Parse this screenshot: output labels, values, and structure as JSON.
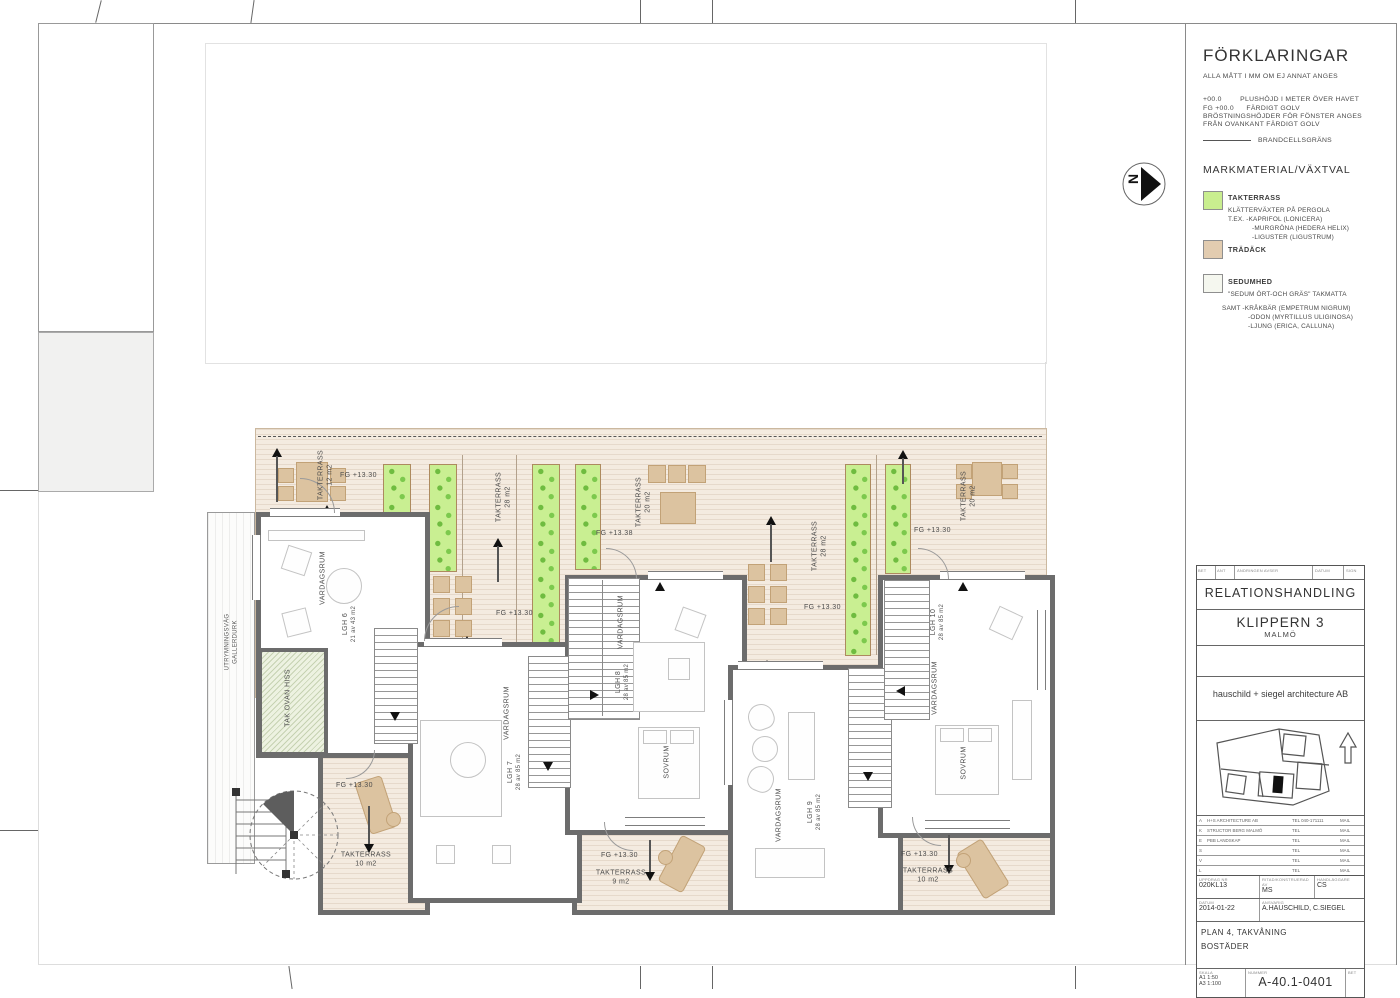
{
  "sheet": {
    "north_letter": "N",
    "legend": {
      "title": "FÖRKLARINGAR",
      "note1": "ALLA MÅTT I MM OM EJ ANNAT ANGES",
      "note2a": "+00.0",
      "note2b": "PLUSHÖJD I METER ÖVER HAVET",
      "note3a": "FG +00.0",
      "note3b": "FÄRDIGT GOLV",
      "note4a": "BRÖSTNINGSHÖJDER  FÖR FÖNSTER ANGES",
      "note4b": "FRÅN OVANKANT FÄRDIGT GOLV",
      "brandcell": "BRANDCELLSGRÄNS",
      "section_title": "MARKMATERIAL/VÄXTVAL",
      "items": [
        {
          "name": "TAKTERRASS",
          "desc1": "KLÄTTERVÄXTER PÅ PERGOLA",
          "desc2": "T.EX.   -KAPRIFOL   (LONICERA)",
          "desc3": "-MURGRÖNA   (HEDERA HELIX)",
          "desc4": "-LIGUSTER (LIGUSTRUM)",
          "color": "#c9ee8f"
        },
        {
          "name": "TRÄDÄCK",
          "color": "#e2ccb0"
        },
        {
          "name": "SEDUMHED",
          "desc1": "\"SEDUM ÖRT-OCH GRÄS\"  TAKMATTA",
          "desc2": "SAMT   -KRÅKBÄR   (EMPETRUM NIGRUM)",
          "desc3": "-ODON   (MYRTILLUS ULIGINOSA)",
          "desc4": "-LJUNG (ERICA, CALLUNA)",
          "color": "#f5f7ef"
        }
      ]
    },
    "titleblock": {
      "rev_cols": [
        "BET",
        "ANT",
        "ÄNDRINGEN AVSER",
        "DATUM",
        "SIGN"
      ],
      "status": "RELATIONSHANDLING",
      "project": "KLIPPERN 3",
      "city": "MALMÖ",
      "firm": "hauschild + siegel architecture AB",
      "consultants": [
        {
          "code": "A",
          "name": "H+S ARCHITECTURE AB",
          "tel": "TEL 040-171111",
          "mail": "MAIL"
        },
        {
          "code": "K",
          "name": "STRUCTOR BERG MALMÖ",
          "tel": "TEL",
          "mail": "MAIL"
        },
        {
          "code": "E",
          "name": "PBB LANDSKAP",
          "tel": "TEL",
          "mail": "MAIL"
        },
        {
          "code": "S",
          "name": "",
          "tel": "TEL",
          "mail": "MAIL"
        },
        {
          "code": "V",
          "name": "",
          "tel": "TEL",
          "mail": "MAIL"
        },
        {
          "code": "L",
          "name": "",
          "tel": "TEL",
          "mail": "MAIL"
        }
      ],
      "labels": {
        "uppdrag": "UPPDRAG NR",
        "ritad": "RITAD/KONSTRUERAD AV",
        "handl": "HANDLÄGGARE",
        "datum": "DATUM",
        "ansvarig": "ANSVARIG",
        "skala": "SKALA",
        "nummer": "NUMMER",
        "bet": "BET"
      },
      "uppdrag_nr": "020KL13",
      "ritad_av": "MS",
      "handlaggare": "CS",
      "datum": "2014-01-22",
      "ansvarig": "A.HAUSCHILD, C.SIEGEL",
      "content_line1": "PLAN 4, TAKVÅNING",
      "content_line2": "BOSTÄDER",
      "skala1": "A1   1:50",
      "skala2": "A3   1:100",
      "nummer": "A-40.1-0401"
    },
    "plan": {
      "apartments": [
        {
          "id": "LGH 6",
          "area": "21 av 43 m2",
          "room": "VARDAGSRUM"
        },
        {
          "id": "LGH 7",
          "area": "28 av 85 m2",
          "room": "VARDAGSRUM"
        },
        {
          "id": "LGH 8",
          "area": "28 av 85 m2",
          "room": "VARDAGSRUM",
          "room2": "SOVRUM"
        },
        {
          "id": "LGH 9",
          "area": "28 av 85 m2",
          "room": "VARDAGSRUM"
        },
        {
          "id": "LGH 10",
          "area": "28 av 85 m2",
          "room": "VARDAGSRUM",
          "room2": "SOVRUM"
        }
      ],
      "terraces": [
        {
          "name": "TAKTERRASS",
          "area": "12 m2"
        },
        {
          "name": "TAKTERRASS",
          "area": "28 m2"
        },
        {
          "name": "TAKTERRASS",
          "area": "20 m2"
        },
        {
          "name": "TAKTERRASS",
          "area": "28 m2"
        },
        {
          "name": "TAKTERRASS",
          "area": "20 m2"
        },
        {
          "name": "TAKTERRASS",
          "area": "10 m2"
        },
        {
          "name": "TAKTERRASS",
          "area": "9 m2"
        },
        {
          "name": "TAKTERRASS",
          "area": "10 m2"
        }
      ],
      "fg_main": "FG +13.30",
      "fg_alt": "FG +13.38",
      "tak_ovan_hiss": "TAK OVAN HISS",
      "utrymning1": "UTRYMNINGSVÄG",
      "utrymning2": "GALLERDURK"
    }
  }
}
